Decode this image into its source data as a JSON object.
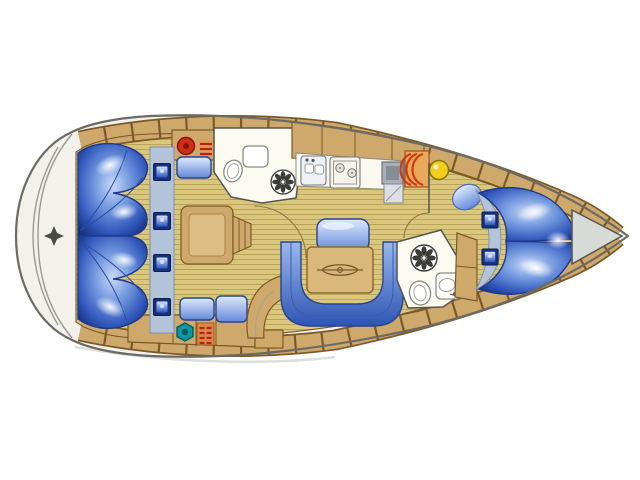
{
  "diagram": {
    "type": "yacht-interior-floor-plan",
    "orientation": "bow-right",
    "rooms": [
      "stern-swim-platform",
      "aft-cabin-port-berth",
      "aft-cabin-starboard-berth",
      "companionway-steps",
      "aft-head",
      "galley",
      "salon-dinette",
      "forward-head",
      "forward-cabin-v-berth",
      "anchor-locker"
    ],
    "fixtures": [
      "shower-fan-icon-aft",
      "shower-fan-icon-forward",
      "toilet-icon-aft",
      "toilet-icon-forward",
      "washbasin-icon-aft",
      "washbasin-icon-forward",
      "galley-sink-icon",
      "stove-icon",
      "fridge-icon",
      "heater-icon",
      "yellow-fitting-icon",
      "red-fitting-icon",
      "teal-fitting-icon",
      "vent-grate-top",
      "vent-grate-bottom",
      "hatch-windows-aft-x4",
      "hatch-windows-forward-x2",
      "dinette-table",
      "table-emblem",
      "u-settee",
      "backrest-cushion",
      "curved-bench",
      "berth-pillow",
      "compass-star"
    ]
  },
  "colors": {
    "hull": "#f2f1ec",
    "hull_outline": "#6b6b64",
    "platform_line": "#9a9a94",
    "deck": "#cfa96b",
    "deck_seam": "#7a5a2a",
    "floor": "#d9c77e",
    "floor_line": "#bda355",
    "room": "#fcfbf2",
    "wall": "#55544e",
    "strip": "#b3c3da",
    "blue_dark": "#16307e",
    "blue_mid": "#3a62c0",
    "table": "#dab87c",
    "table_line": "#8a6a33",
    "emblem": "#7a5c28",
    "accent_red": "#cf2d1a",
    "accent_teal": "#0f98a2",
    "accent_yellow": "#f2cf1d",
    "heater_orange": "#e9a85c",
    "stripe_red": "#bb2211",
    "fridge_gray": "#aab0b9",
    "anchor_gray": "#d7dad6"
  }
}
